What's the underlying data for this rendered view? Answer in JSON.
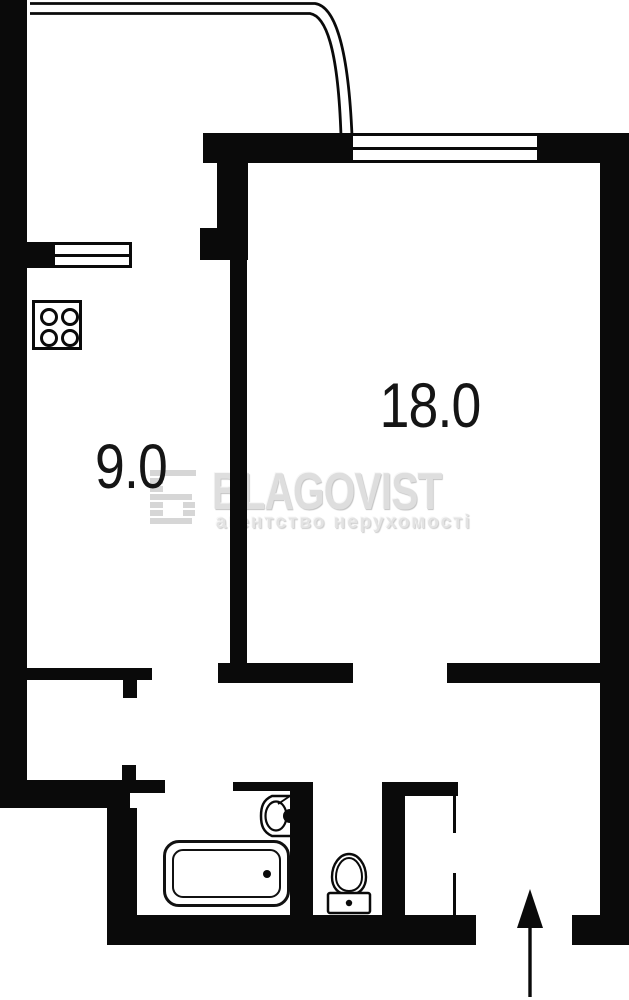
{
  "plan": {
    "type": "apartment-floor-plan",
    "rooms": [
      {
        "id": "kitchen",
        "area_label": "9.0"
      },
      {
        "id": "living-room",
        "area_label": "18.0"
      }
    ],
    "fixtures": [
      "stove-icon",
      "bathtub-icon",
      "sink-icon",
      "toilet-icon"
    ],
    "entrance_arrow_direction": "up",
    "colors": {
      "wall": "#0a0a0a",
      "background": "#ffffff",
      "label_text": "#151515",
      "watermark_brand": "#dedede",
      "watermark_tagline": "#e3e3e3"
    }
  },
  "watermark": {
    "logo": "Б",
    "brand": "BLAGOVIST",
    "tagline": "агентство нерухомості"
  }
}
